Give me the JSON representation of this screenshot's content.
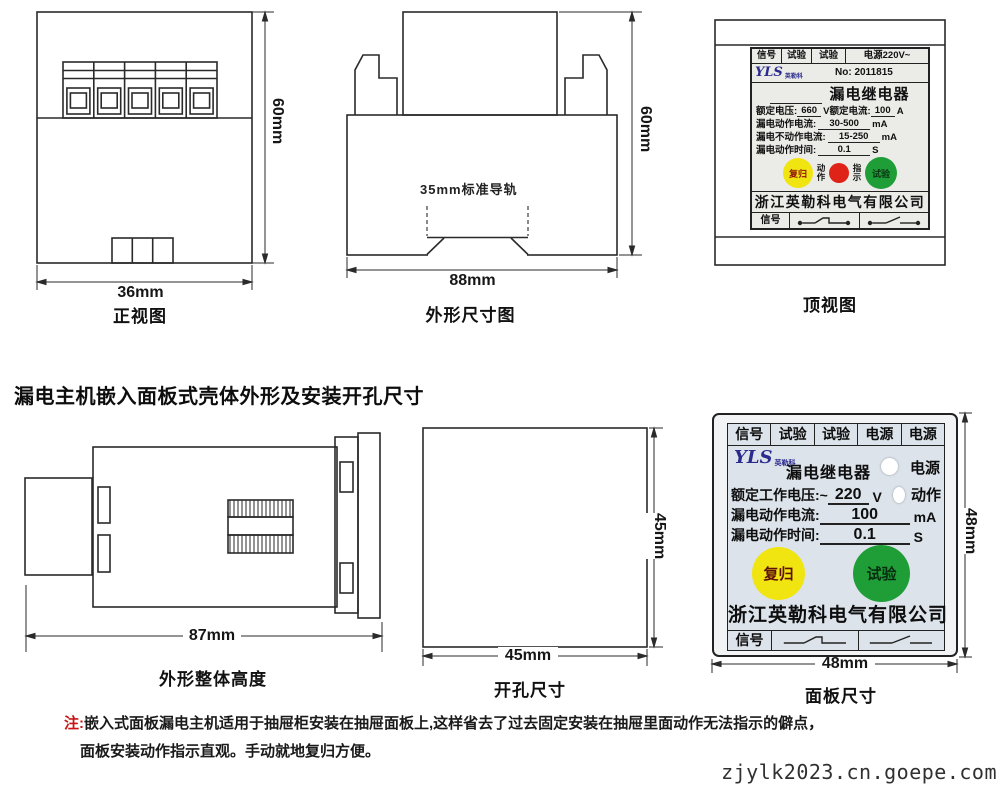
{
  "colors": {
    "ink": "#222222",
    "yellow": "#f0e411",
    "red": "#e02318",
    "green": "#1f9e38",
    "navy": "#2b2b8e",
    "label_bg": "#ebebe7",
    "panel_bg": "#dce3ea",
    "note_red": "#c81414"
  },
  "title": {
    "section": "漏电主机嵌入面板式壳体外形及安装开孔尺寸"
  },
  "views": {
    "front": {
      "caption": "正视图",
      "width": "36mm",
      "height": "60mm"
    },
    "outline": {
      "caption": "外形尺寸图",
      "width": "88mm",
      "height": "60mm",
      "rail": "35mm标准导轨"
    },
    "top": {
      "caption": "顶视图"
    },
    "profile": {
      "caption": "外形整体高度",
      "width": "87mm"
    },
    "cutout": {
      "caption": "开孔尺寸",
      "width": "45mm",
      "height": "45mm"
    },
    "panel": {
      "caption": "面板尺寸",
      "width": "48mm",
      "height": "48mm"
    }
  },
  "top_label": {
    "terminals": [
      "信号",
      "试验",
      "试验",
      "电源220V~"
    ],
    "logo_text": "YLS",
    "logo_sub": "英勒科",
    "serial": "No: 2011815",
    "product": "漏电继电器",
    "spec_row1": {
      "n1": "额定电压:",
      "v1": "660",
      "u1": "V",
      "n2": "额定电流:",
      "v2": "100",
      "u2": "A"
    },
    "specs": [
      {
        "name": "漏电动作电流:",
        "value": "30-500",
        "unit": "mA"
      },
      {
        "name": "漏电不动作电流:",
        "value": "15-250",
        "unit": "mA"
      },
      {
        "name": "漏电动作时间:",
        "value": "0.1",
        "unit": "S"
      }
    ],
    "buttons": {
      "reset": "复归",
      "test": "试验"
    },
    "indicator": {
      "left": "动作",
      "right": "指示"
    },
    "company": "浙江英勒科电气有限公司",
    "signal": "信号"
  },
  "front_panel": {
    "terminals": [
      "信号",
      "试验",
      "试验",
      "电源",
      "电源"
    ],
    "logo_text": "YLS",
    "logo_sub": "英勒科",
    "product": "漏电继电器",
    "leds": [
      {
        "label": "电源"
      },
      {
        "label": "动作"
      }
    ],
    "specs": [
      {
        "name": "额定工作电压:~",
        "value": "220",
        "unit": "V"
      },
      {
        "name": "漏电动作电流:",
        "value": "100",
        "unit": "mA"
      },
      {
        "name": "漏电动作时间:",
        "value": "0.1",
        "unit": "S"
      }
    ],
    "buttons": {
      "reset": "复归",
      "test": "试验"
    },
    "company": "浙江英勒科电气有限公司",
    "signal": "信号"
  },
  "note": {
    "prefix": "注:",
    "line1": "嵌入式面板漏电主机适用于抽屉柜安装在抽屉面板上,这样省去了过去固定安装在抽屉里面动作无法指示的僻点，",
    "line2": "面板安装动作指示直观。手动就地复归方便。"
  },
  "watermark": "zjylk2023.cn.goepe.com"
}
